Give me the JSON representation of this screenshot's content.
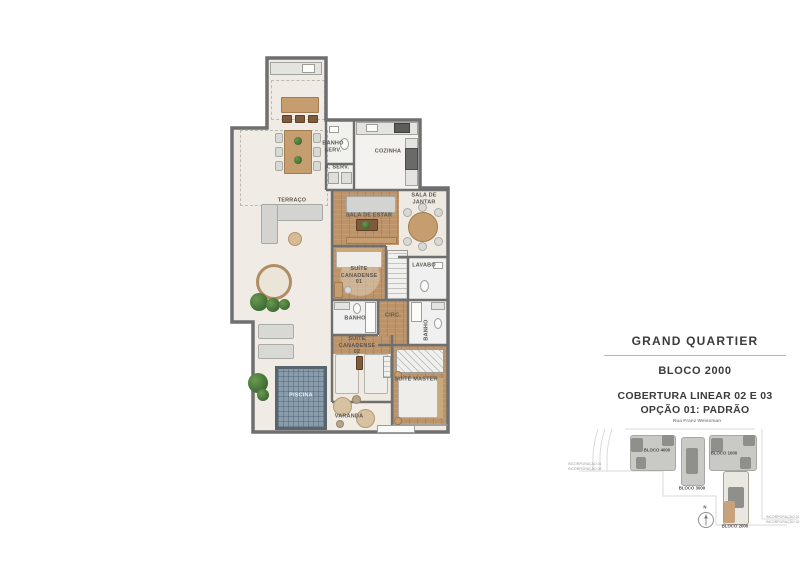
{
  "title_block": {
    "project": "GRAND QUARTIER",
    "block": "BLOCO 2000",
    "subtitle_line1": "COBERTURA LINEAR 02 E 03",
    "subtitle_line2": "OPÇÃO 01: PADRÃO"
  },
  "floor_plan": {
    "rooms": {
      "terraco": "TERRAÇO",
      "banho_serv": "BANHO SERV.",
      "cozinha": "COZINHA",
      "a_serv": "A. SERV.",
      "sala_de_estar": "SALA DE ESTAR",
      "sala_de_jantar": "SALA DE JANTAR",
      "lavabo": "LAVABO",
      "suite_canadense_01": "SUÍTE CANADENSE 01",
      "banho_01": "BANHO",
      "circ": "CIRC.",
      "banho_02": "BANHO",
      "suite_canadense_02": "SUÍTE CANADENSE 02",
      "suite_master": "SUÍTE MASTER",
      "piscina": "PISCINA",
      "varanda": "VARANDA"
    }
  },
  "site_map": {
    "street": "Rua Franz Weissman",
    "north_label": "N",
    "blocks": [
      {
        "label": "BLOCO 4000",
        "highlighted": false
      },
      {
        "label": "BLOCO 3000",
        "highlighted": false
      },
      {
        "label": "BLOCO 1000",
        "highlighted": false
      },
      {
        "label": "BLOCO 2000",
        "highlighted": true
      }
    ],
    "notes_left": [
      "INCORPORAÇÃO 01",
      "INCORPORAÇÃO 02"
    ],
    "notes_right": [
      "INCORPORAÇÃO 01",
      "INCORPORAÇÃO 02"
    ]
  },
  "colors": {
    "wall": "#6f6f6f",
    "floor": "#f0ece5",
    "wood": "#bd9469",
    "pool": "#889cac",
    "divider": "#c8b19a",
    "highlight_block": "#c8a27d",
    "title_text": "#3b3b3b"
  }
}
